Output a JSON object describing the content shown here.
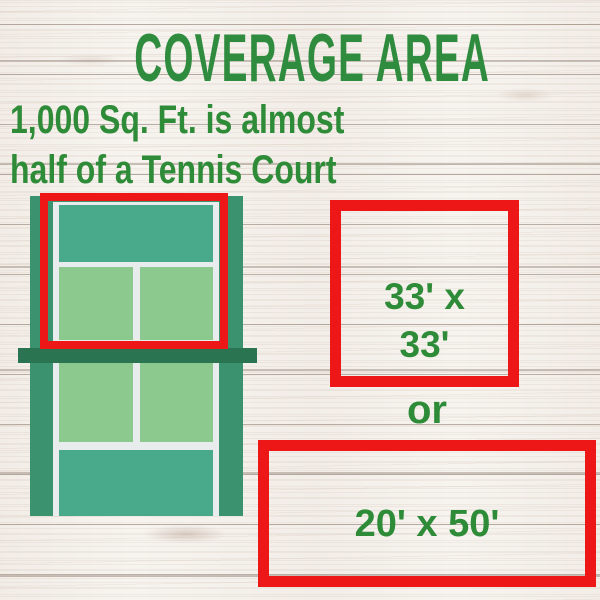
{
  "header": {
    "title": "COVERAGE AREA",
    "subtitle_line1": "1,000 Sq. Ft. is almost",
    "subtitle_line2": "half of a Tennis Court"
  },
  "coverage": {
    "square_option": {
      "line1": "33' x",
      "line2": "33'"
    },
    "or_label": "or",
    "wide_option": {
      "label": "20' x 50'"
    }
  },
  "illustration": {
    "name": "tennis-court",
    "highlighted_region": "half of court inside red outline"
  },
  "colors": {
    "title_green": "#2f8c3e",
    "label_green": "#2e8b38",
    "highlight_red": "#ee1717",
    "court_frame_green": "#3b926e",
    "court_backcourt_teal": "#48aa8b",
    "court_service_green": "#8cc98e",
    "court_net_green": "#2b7452",
    "court_line_white": "#e9ecec",
    "wood_background": "#f7f4f0"
  }
}
